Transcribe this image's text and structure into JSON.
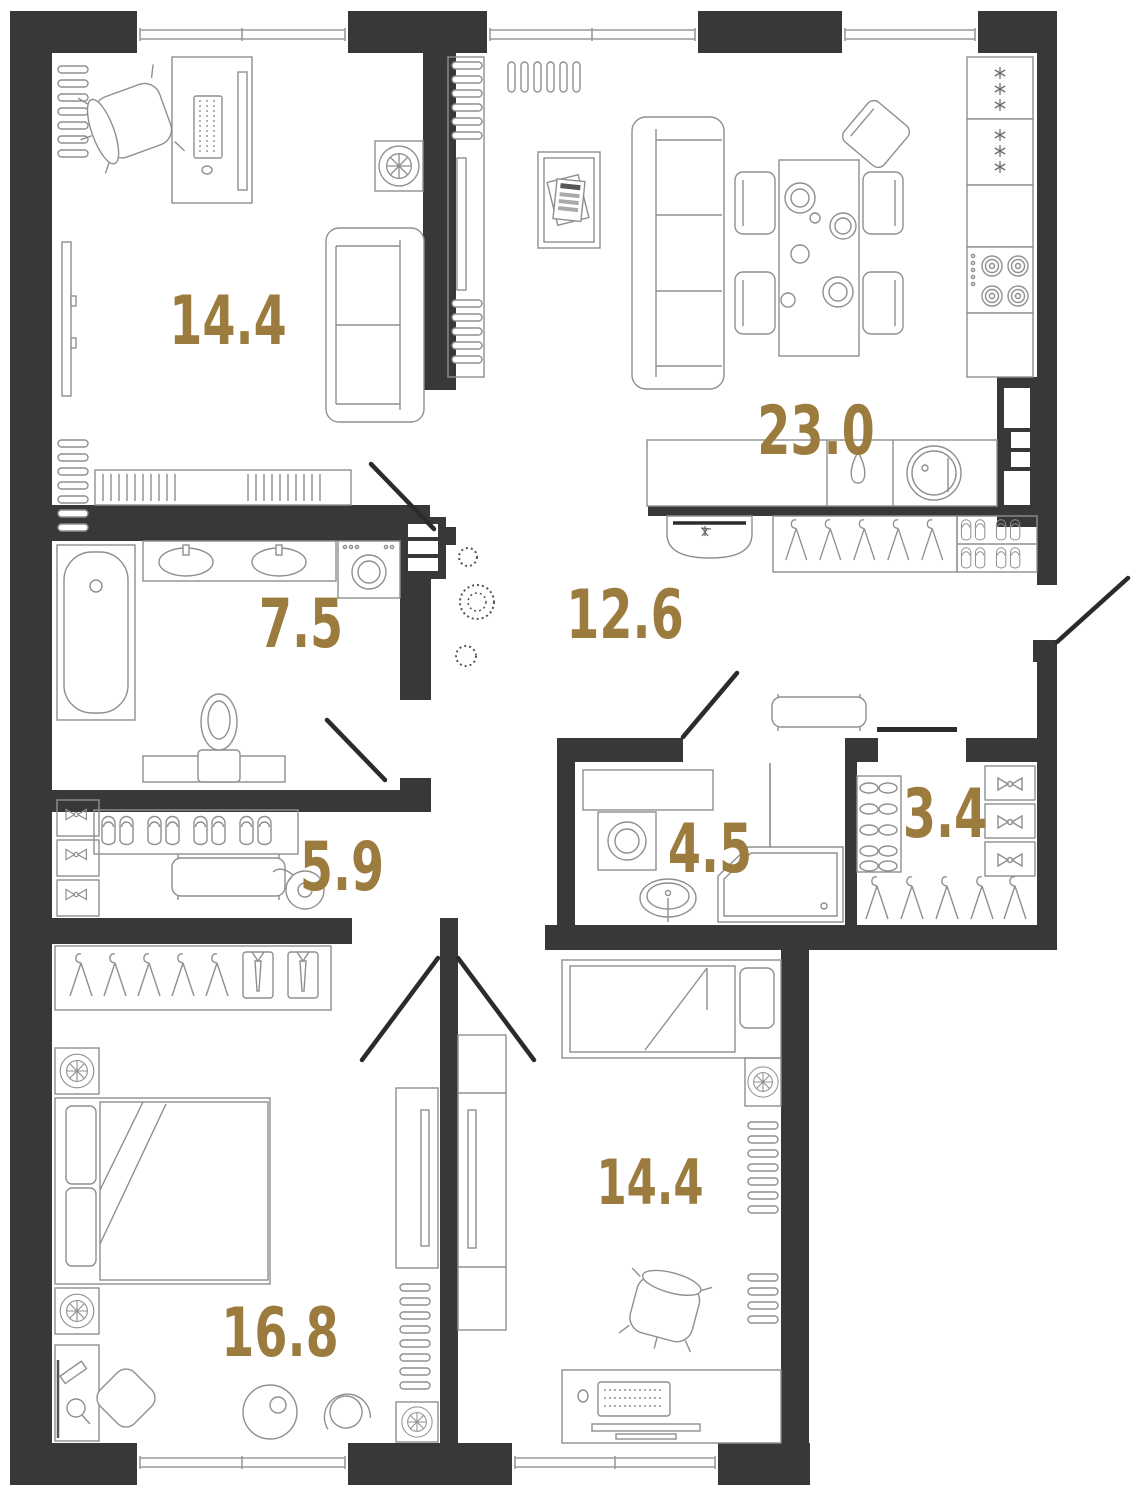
{
  "plan": {
    "title": "3-room apartment floor plan",
    "rooms": [
      {
        "id": "study",
        "area": "14.4"
      },
      {
        "id": "living-kitchen",
        "area": "23.0"
      },
      {
        "id": "bathroom-big",
        "area": "7.5"
      },
      {
        "id": "hallway",
        "area": "12.6"
      },
      {
        "id": "wardrobe-hall",
        "area": "5.9"
      },
      {
        "id": "shower-room",
        "area": "4.5"
      },
      {
        "id": "closet",
        "area": "3.4"
      },
      {
        "id": "bedroom",
        "area": "16.8"
      },
      {
        "id": "bedroom-2",
        "area": "14.4"
      }
    ],
    "colors": {
      "wall": "#3a3836",
      "room_label": "#9c7c3e",
      "furniture_stroke": "#8f8f8f",
      "floor": "#ffffff",
      "door_leaf": "#2b2b2b"
    }
  }
}
